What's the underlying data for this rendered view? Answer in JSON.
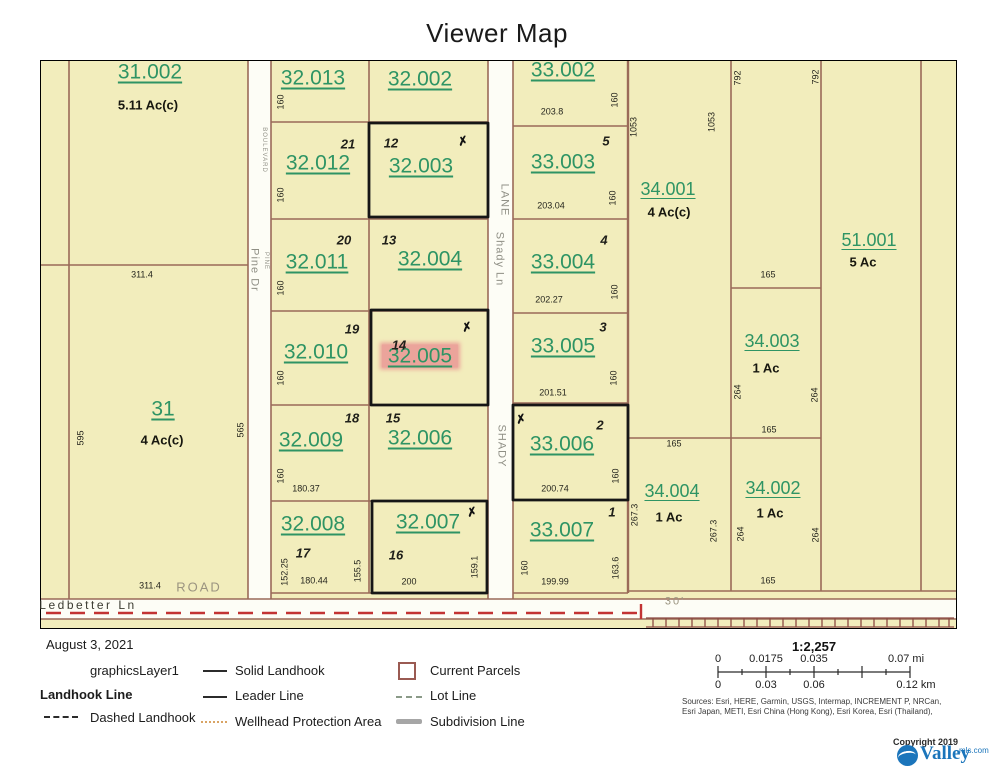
{
  "title": "Viewer Map",
  "map": {
    "parcel_ids": [
      {
        "t": "31.002",
        "x": 150,
        "y": 72,
        "s": 21
      },
      {
        "t": "32.013",
        "x": 313,
        "y": 78,
        "s": 21
      },
      {
        "t": "32.002",
        "x": 420,
        "y": 79,
        "s": 21
      },
      {
        "t": "33.002",
        "x": 563,
        "y": 70,
        "s": 21
      },
      {
        "t": "32.012",
        "x": 318,
        "y": 163,
        "s": 21
      },
      {
        "t": "32.003",
        "x": 421,
        "y": 166,
        "s": 21
      },
      {
        "t": "33.003",
        "x": 563,
        "y": 162,
        "s": 21
      },
      {
        "t": "34.001",
        "x": 668,
        "y": 189,
        "s": 18
      },
      {
        "t": "51.001",
        "x": 869,
        "y": 240,
        "s": 18
      },
      {
        "t": "32.011",
        "x": 317,
        "y": 262,
        "s": 21
      },
      {
        "t": "32.004",
        "x": 430,
        "y": 259,
        "s": 21
      },
      {
        "t": "33.004",
        "x": 563,
        "y": 262,
        "s": 21
      },
      {
        "t": "34.003",
        "x": 772,
        "y": 341,
        "s": 18
      },
      {
        "t": "32.010",
        "x": 316,
        "y": 352,
        "s": 21
      },
      {
        "t": "32.005",
        "x": 420,
        "y": 356,
        "s": 21,
        "hl": true
      },
      {
        "t": "33.005",
        "x": 563,
        "y": 346,
        "s": 21
      },
      {
        "t": "31",
        "x": 163,
        "y": 409,
        "s": 21
      },
      {
        "t": "32.009",
        "x": 311,
        "y": 440,
        "s": 21
      },
      {
        "t": "32.006",
        "x": 420,
        "y": 438,
        "s": 21
      },
      {
        "t": "33.006",
        "x": 562,
        "y": 444,
        "s": 21
      },
      {
        "t": "34.004",
        "x": 672,
        "y": 491,
        "s": 18
      },
      {
        "t": "34.002",
        "x": 773,
        "y": 488,
        "s": 18
      },
      {
        "t": "32.008",
        "x": 313,
        "y": 524,
        "s": 21
      },
      {
        "t": "32.007",
        "x": 428,
        "y": 522,
        "s": 21
      },
      {
        "t": "33.007",
        "x": 562,
        "y": 530,
        "s": 21
      }
    ],
    "acreages": [
      {
        "t": "5.11 Ac(c)",
        "x": 148,
        "y": 105
      },
      {
        "t": "4 Ac(c)",
        "x": 669,
        "y": 212
      },
      {
        "t": "5 Ac",
        "x": 863,
        "y": 262
      },
      {
        "t": "1 Ac",
        "x": 766,
        "y": 368
      },
      {
        "t": "4 Ac(c)",
        "x": 162,
        "y": 440
      },
      {
        "t": "1 Ac",
        "x": 669,
        "y": 517
      },
      {
        "t": "1 Ac",
        "x": 770,
        "y": 513
      }
    ],
    "lots": [
      {
        "t": "21",
        "x": 348,
        "y": 144
      },
      {
        "t": "12",
        "x": 391,
        "y": 143
      },
      {
        "t": "5",
        "x": 606,
        "y": 141
      },
      {
        "t": "20",
        "x": 344,
        "y": 240
      },
      {
        "t": "13",
        "x": 389,
        "y": 240
      },
      {
        "t": "4",
        "x": 604,
        "y": 240
      },
      {
        "t": "19",
        "x": 352,
        "y": 329
      },
      {
        "t": "14",
        "x": 399,
        "y": 345
      },
      {
        "t": "3",
        "x": 603,
        "y": 327
      },
      {
        "t": "18",
        "x": 352,
        "y": 418
      },
      {
        "t": "15",
        "x": 393,
        "y": 418
      },
      {
        "t": "2",
        "x": 600,
        "y": 425
      },
      {
        "t": "17",
        "x": 303,
        "y": 553
      },
      {
        "t": "16",
        "x": 396,
        "y": 555
      },
      {
        "t": "1",
        "x": 612,
        "y": 512
      }
    ],
    "dims": [
      {
        "t": "160",
        "x": 281,
        "y": 102,
        "r": 1
      },
      {
        "t": "160",
        "x": 281,
        "y": 195,
        "r": 1
      },
      {
        "t": "160",
        "x": 281,
        "y": 288,
        "r": 1
      },
      {
        "t": "160",
        "x": 281,
        "y": 378,
        "r": 1
      },
      {
        "t": "160",
        "x": 281,
        "y": 476,
        "r": 1
      },
      {
        "t": "180.37",
        "x": 306,
        "y": 489
      },
      {
        "t": "152.25",
        "x": 285,
        "y": 572,
        "r": 1
      },
      {
        "t": "180.44",
        "x": 314,
        "y": 581
      },
      {
        "t": "155.5",
        "x": 358,
        "y": 571,
        "r": 1
      },
      {
        "t": "200",
        "x": 409,
        "y": 582
      },
      {
        "t": "159.1",
        "x": 475,
        "y": 567,
        "r": 1
      },
      {
        "t": "203.8",
        "x": 552,
        "y": 112
      },
      {
        "t": "160",
        "x": 615,
        "y": 100,
        "r": 1
      },
      {
        "t": "203.04",
        "x": 551,
        "y": 206
      },
      {
        "t": "160",
        "x": 613,
        "y": 198,
        "r": 1
      },
      {
        "t": "202.27",
        "x": 549,
        "y": 300
      },
      {
        "t": "160",
        "x": 615,
        "y": 292,
        "r": 1
      },
      {
        "t": "201.51",
        "x": 553,
        "y": 393
      },
      {
        "t": "160",
        "x": 614,
        "y": 378,
        "r": 1
      },
      {
        "t": "200.74",
        "x": 555,
        "y": 489
      },
      {
        "t": "160",
        "x": 616,
        "y": 476,
        "r": 1
      },
      {
        "t": "199.99",
        "x": 555,
        "y": 582
      },
      {
        "t": "160",
        "x": 525,
        "y": 568,
        "r": 1
      },
      {
        "t": "163.6",
        "x": 616,
        "y": 568,
        "r": 1
      },
      {
        "t": "1053",
        "x": 634,
        "y": 127,
        "r": 1
      },
      {
        "t": "1053",
        "x": 712,
        "y": 122,
        "r": 1
      },
      {
        "t": "792",
        "x": 738,
        "y": 78,
        "r": 1
      },
      {
        "t": "792",
        "x": 816,
        "y": 77,
        "r": 1
      },
      {
        "t": "165",
        "x": 768,
        "y": 275
      },
      {
        "t": "264",
        "x": 738,
        "y": 392,
        "r": 1
      },
      {
        "t": "264",
        "x": 815,
        "y": 395,
        "r": 1
      },
      {
        "t": "165",
        "x": 769,
        "y": 430
      },
      {
        "t": "165",
        "x": 674,
        "y": 444
      },
      {
        "t": "267.3",
        "x": 635,
        "y": 515,
        "r": 1
      },
      {
        "t": "267.3",
        "x": 714,
        "y": 531,
        "r": 1
      },
      {
        "t": "264",
        "x": 741,
        "y": 534,
        "r": 1
      },
      {
        "t": "264",
        "x": 816,
        "y": 535,
        "r": 1
      },
      {
        "t": "165",
        "x": 768,
        "y": 581
      },
      {
        "t": "311.4",
        "x": 142,
        "y": 275
      },
      {
        "t": "595",
        "x": 81,
        "y": 438,
        "r": 1
      },
      {
        "t": "565",
        "x": 241,
        "y": 430,
        "r": 1
      },
      {
        "t": "311.4",
        "x": 150,
        "y": 586
      }
    ],
    "roads": [
      {
        "t": "BOULEVARD",
        "x": 264,
        "y": 150,
        "r": 1,
        "s": 6
      },
      {
        "t": "PINE",
        "x": 266,
        "y": 261,
        "r": 1,
        "s": 6
      },
      {
        "t": "Pine Dr",
        "x": 254,
        "y": 270,
        "r": 1,
        "s": 11
      },
      {
        "t": "LANE",
        "x": 504,
        "y": 200,
        "r": 1,
        "s": 11
      },
      {
        "t": "Shady Ln",
        "x": 499,
        "y": 259,
        "r": 1,
        "s": 11
      },
      {
        "t": "SHADY",
        "x": 501,
        "y": 446,
        "r": 1,
        "s": 11
      },
      {
        "t": "ROAD",
        "x": 199,
        "y": 587,
        "s": 13,
        "tan": true
      },
      {
        "t": "30'",
        "x": 675,
        "y": 602,
        "s": 11,
        "tan": true
      },
      {
        "t": "Ledbetter Ln",
        "x": 88,
        "y": 605,
        "s": 12,
        "dark": true
      }
    ],
    "xmarks": [
      {
        "x": 463,
        "y": 141
      },
      {
        "x": 467,
        "y": 327
      },
      {
        "x": 472,
        "y": 512
      },
      {
        "x": 521,
        "y": 419
      }
    ],
    "xmark_glyph": "✗"
  },
  "legend": {
    "date": "August 3, 2021",
    "layer_name": "graphicsLayer1",
    "group_title": "Landhook Line",
    "dashed_item": "Dashed Landhook",
    "items_col2": [
      "Solid Landhook",
      "Leader Line",
      "Wellhead Protection Area"
    ],
    "items_col3": [
      "Current Parcels",
      "Lot Line",
      "Subdivision Line"
    ]
  },
  "scalebar": {
    "ratio": "1:2,257",
    "mi": [
      "0",
      "0.0175",
      "0.035",
      "0.07 mi"
    ],
    "km": [
      "0",
      "0.03",
      "0.06",
      "0.12 km"
    ]
  },
  "attribution": {
    "sources_line1": "Sources: Esri, HERE, Garmin, USGS, Intermap, INCREMENT P, NRCan,",
    "sources_line2": "Esri Japan, METI, Esri China (Hong Kong), Esri Korea, Esri (Thailand),",
    "copyright": "Copyright 2019",
    "logo_text": "Valley",
    "logo_suffix": "mls.com"
  },
  "colors": {
    "parcel_fill": "#f2edbc",
    "parcel_line": "#9a6a58",
    "parcel_id_green": "#2e9464",
    "highlight_pink": "#eba49b",
    "graphics_black": "#161616",
    "landhook_red": "#c23333",
    "hatch_maroon": "#8c4a42",
    "road_white": "#fdfdf6",
    "valley_blue": "#1b75bb"
  }
}
